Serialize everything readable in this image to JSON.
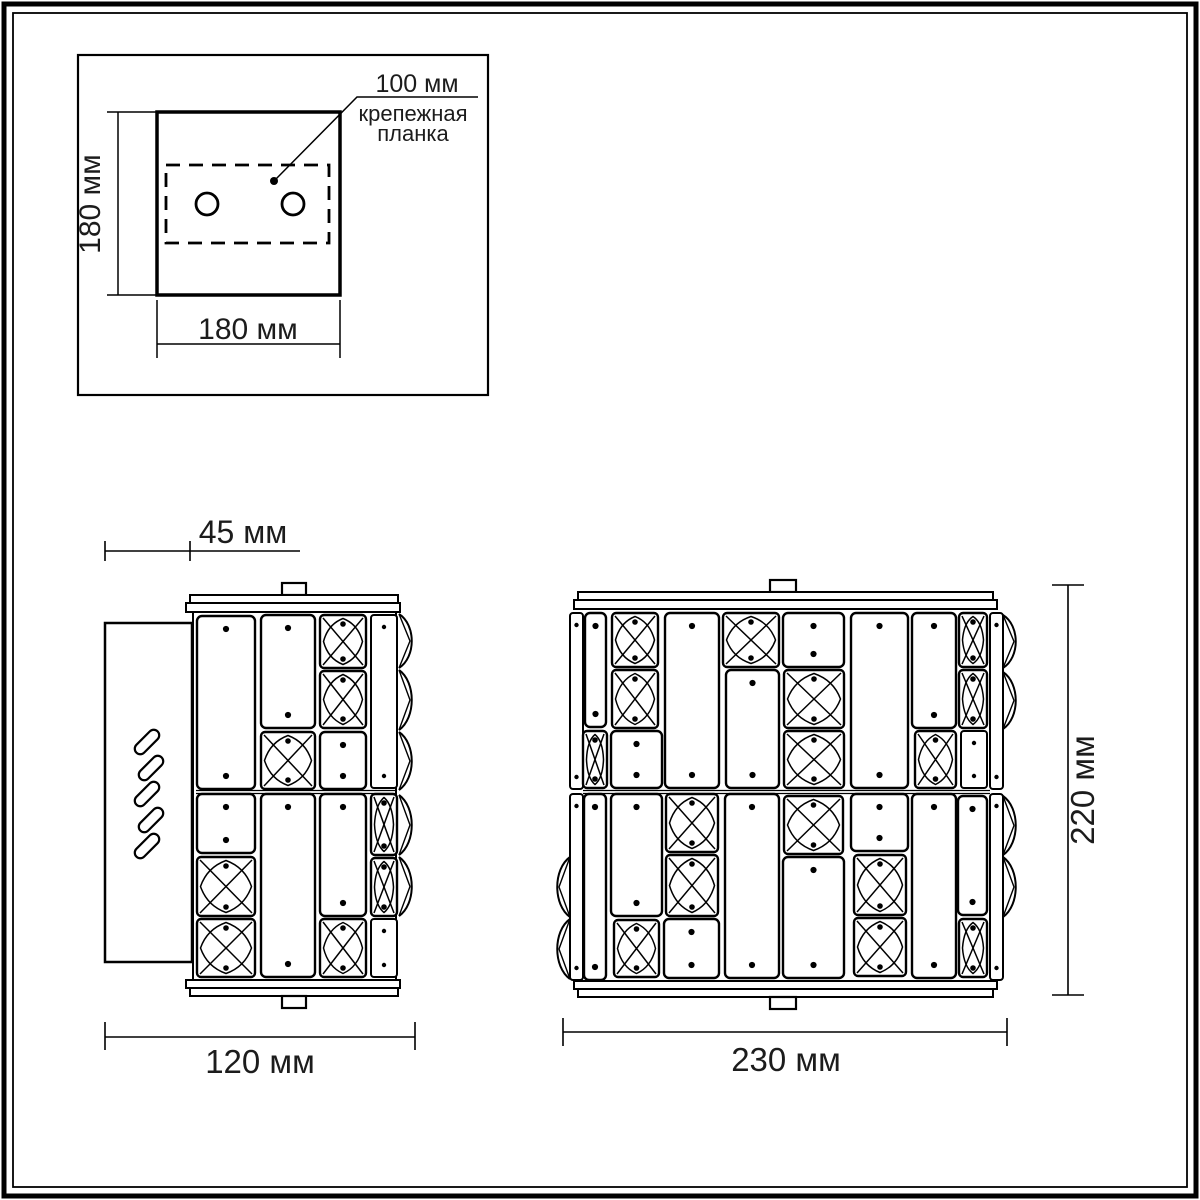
{
  "document": {
    "kind": "wall-lamp technical drawing",
    "unit": "мм"
  },
  "colors": {
    "line": "#000000",
    "text": "#1c1c1c",
    "background": "#ffffff"
  },
  "mounting_view": {
    "height_label": "180 мм",
    "width_label": "180 мм",
    "bracket_size_label": "100 мм",
    "bracket_name_line1": "крепежная",
    "bracket_name_line2": "планка",
    "holes_count": 2
  },
  "side_view": {
    "depth_label": "45 мм",
    "width_label": "120 мм",
    "vent_slots_count": 5
  },
  "front_view": {
    "width_label": "230 мм",
    "height_label": "220 мм"
  },
  "drawing": {
    "side_tiles": [
      [
        "r",
        197,
        616,
        58,
        173
      ],
      [
        "r",
        261,
        615,
        54,
        113
      ],
      [
        "x",
        261,
        732,
        54,
        57
      ],
      [
        "x",
        320,
        615,
        46,
        53
      ],
      [
        "x",
        320,
        671,
        46,
        57
      ],
      [
        "r",
        320,
        732,
        46,
        57
      ],
      [
        "n",
        371,
        615,
        26,
        173
      ],
      [
        "r",
        197,
        794,
        58,
        59
      ],
      [
        "x",
        197,
        857,
        58,
        59
      ],
      [
        "x",
        197,
        919,
        58,
        58
      ],
      [
        "r",
        261,
        794,
        54,
        183
      ],
      [
        "r",
        320,
        794,
        46,
        122
      ],
      [
        "x",
        320,
        919,
        46,
        58
      ],
      [
        "x",
        371,
        794,
        26,
        61
      ],
      [
        "x",
        371,
        858,
        26,
        58
      ],
      [
        "n",
        371,
        919,
        26,
        58
      ]
    ],
    "front_tiles": [
      [
        "n",
        570,
        613,
        13,
        176
      ],
      [
        "n",
        570,
        794,
        13,
        186
      ],
      [
        "n",
        990,
        613,
        13,
        176
      ],
      [
        "n",
        990,
        794,
        13,
        186
      ],
      [
        "r",
        585,
        613,
        21,
        114
      ],
      [
        "x",
        583,
        731,
        24,
        57
      ],
      [
        "x",
        612,
        613,
        46,
        54
      ],
      [
        "x",
        612,
        670,
        46,
        58
      ],
      [
        "r",
        611,
        731,
        51,
        57
      ],
      [
        "r",
        665,
        613,
        54,
        175
      ],
      [
        "x",
        723,
        613,
        56,
        54
      ],
      [
        "r",
        726,
        670,
        53,
        118
      ],
      [
        "r",
        783,
        613,
        61,
        54
      ],
      [
        "x",
        784,
        670,
        60,
        58
      ],
      [
        "x",
        784,
        731,
        60,
        57
      ],
      [
        "r",
        851,
        613,
        57,
        175
      ],
      [
        "r",
        912,
        613,
        44,
        115
      ],
      [
        "x",
        915,
        731,
        41,
        57
      ],
      [
        "x",
        959,
        613,
        28,
        54
      ],
      [
        "x",
        959,
        670,
        28,
        58
      ],
      [
        "n",
        961,
        731,
        26,
        57
      ],
      [
        "r",
        584,
        794,
        22,
        186
      ],
      [
        "r",
        611,
        794,
        51,
        122
      ],
      [
        "x",
        614,
        920,
        45,
        57
      ],
      [
        "x",
        666,
        794,
        52,
        58
      ],
      [
        "x",
        666,
        855,
        52,
        61
      ],
      [
        "r",
        664,
        919,
        55,
        59
      ],
      [
        "r",
        725,
        794,
        54,
        184
      ],
      [
        "x",
        784,
        796,
        59,
        58
      ],
      [
        "r",
        783,
        857,
        61,
        121
      ],
      [
        "r",
        851,
        794,
        57,
        57
      ],
      [
        "x",
        854,
        855,
        52,
        60
      ],
      [
        "x",
        854,
        918,
        52,
        58
      ],
      [
        "r",
        912,
        794,
        44,
        184
      ],
      [
        "r",
        958,
        796,
        29,
        119
      ],
      [
        "x",
        959,
        919,
        28,
        58
      ]
    ],
    "side_bumps_right": {
      "x": 399,
      "dir": 1,
      "spans": [
        [
          614,
          54
        ],
        [
          670,
          60
        ],
        [
          732,
          58
        ],
        [
          795,
          60
        ],
        [
          857,
          59
        ]
      ]
    },
    "front_bumps_right": {
      "x": 1003,
      "dir": 1,
      "spans": [
        [
          615,
          53
        ],
        [
          672,
          57
        ],
        [
          796,
          59
        ],
        [
          857,
          60
        ]
      ]
    },
    "front_bumps_left": {
      "x": 570,
      "dir": -1,
      "spans": [
        [
          857,
          60
        ],
        [
          919,
          60
        ]
      ]
    },
    "vent_slots": {
      "count": 5,
      "cx_even": 147,
      "cx_odd": 151,
      "start_y": 742,
      "step_y": 26,
      "length": 30,
      "width": 11
    }
  }
}
